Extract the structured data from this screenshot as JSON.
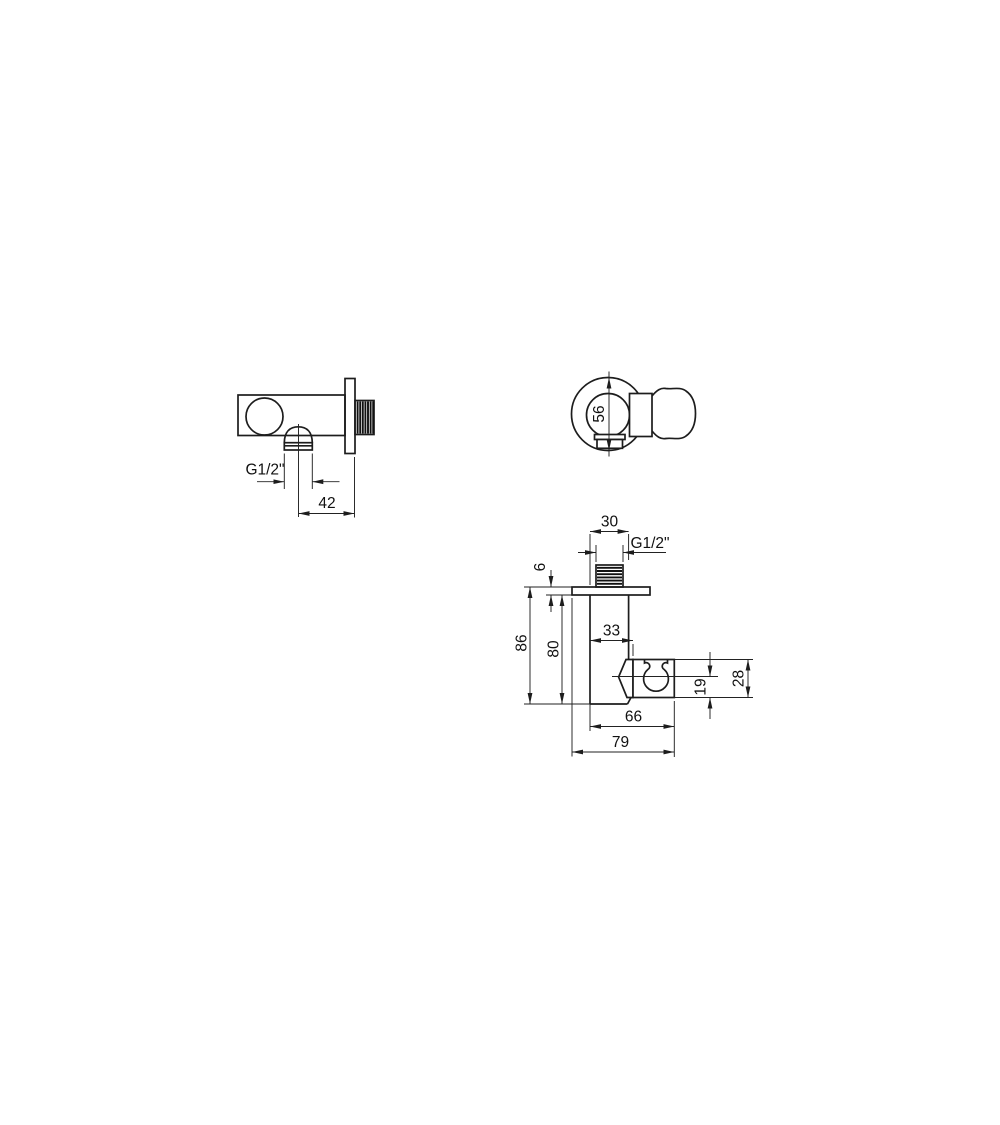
{
  "drawing": {
    "colors": {
      "line": "#1d1d1d",
      "dimension": "#222222",
      "background": "#ffffff"
    },
    "side_view": {
      "thread_label": "G1/2\"",
      "wall_distance": "42"
    },
    "front_view": {
      "flange_diameter": "56"
    },
    "profile_view": {
      "body_width": "30",
      "thread_label": "G1/2\"",
      "flange_thickness": "6",
      "total_height": "86",
      "body_height": "80",
      "holder_offset": "33",
      "axis_to_bottom": "19",
      "holder_height": "28",
      "holder_width": "66",
      "total_width": "79"
    }
  }
}
